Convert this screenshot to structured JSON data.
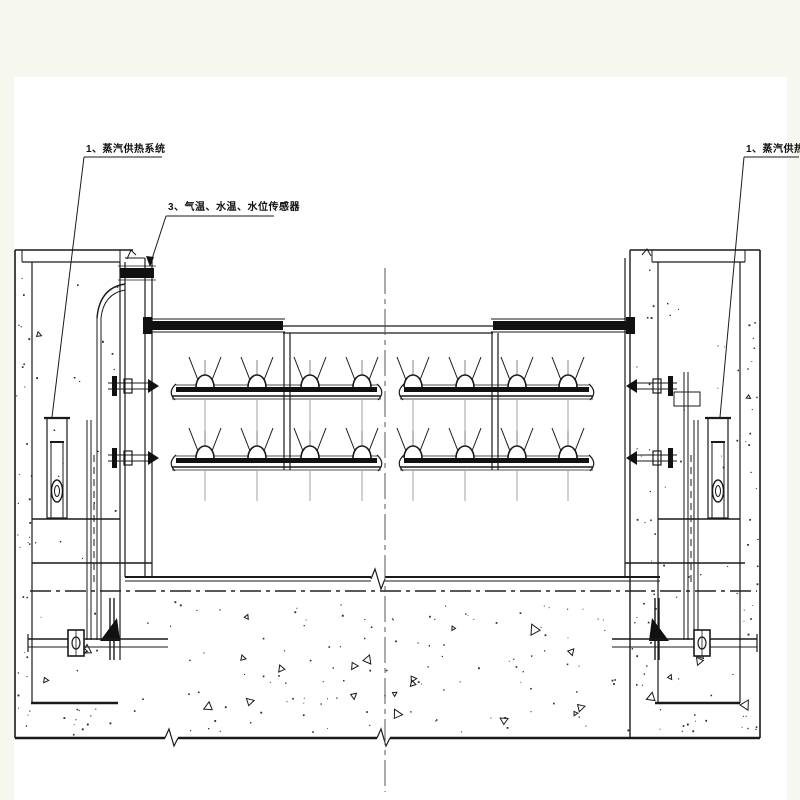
{
  "colors": {
    "background": "#f6f8f0",
    "sheet": "#ffffff",
    "ink": "#1a1a1a",
    "centerline": "#555555"
  },
  "labels": {
    "steam_system_left": "1、蒸汽供热系统",
    "sensors": "3、气温、水温、水位传感器",
    "steam_system_right": "1、蒸汽供热系统"
  },
  "drawing": {
    "kind": "gate-heating-section",
    "nozzle_rows": 2,
    "nozzles_per_panel": 4,
    "panels": 2
  }
}
